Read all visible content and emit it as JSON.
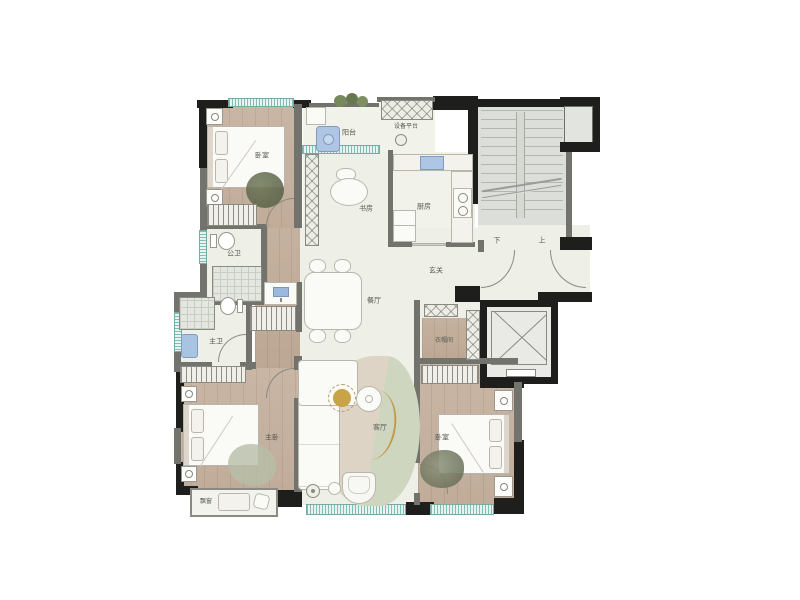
{
  "plan_type": "residential-floor-plan",
  "colors": {
    "wall_black": "#1e1e1c",
    "wall_gray": "#73736d",
    "wood_floor": "#c5b1a0",
    "light_floor": "#eef0e8",
    "window_teal": "#7fbdb5",
    "accent_gold": "#c9a348",
    "appliance_blue": "#a9c3e2",
    "plant_green": "#77885c",
    "rug_olive": "#5f684d"
  },
  "rooms": {
    "bedroom_top_left": "卧室",
    "balcony": "阳台",
    "equipment_platform": "设备平台",
    "study": "书房",
    "kitchen": "厨房",
    "entry": "玄关",
    "stair_down": "下",
    "stair_up": "上",
    "public_bathroom": "公卫",
    "master_bathroom": "主卫",
    "dining": "餐厅",
    "master_bedroom": "主卧",
    "living": "客厅",
    "bay_window": "飘窗",
    "cloakroom": "衣帽间",
    "bedroom_bottom_right": "卧室"
  }
}
